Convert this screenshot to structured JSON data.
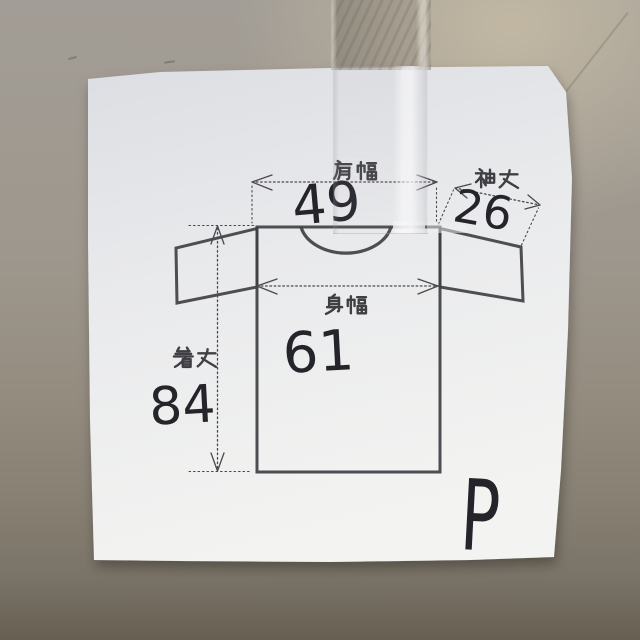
{
  "measurements": {
    "shoulder_width": {
      "label": "肩幅",
      "value": "49"
    },
    "sleeve_length": {
      "label": "袖丈",
      "value": "26"
    },
    "body_width": {
      "label": "身幅",
      "value": "61"
    },
    "garment_length": {
      "label": "着丈",
      "value": "84"
    }
  },
  "size_mark": "P",
  "colors": {
    "paper": "#ecedef",
    "ink_print": "#403f44",
    "ink_pen": "#26242b",
    "wall_top": "#a7a199",
    "wall_bottom": "#6a6357",
    "tape": "#8f887b"
  }
}
